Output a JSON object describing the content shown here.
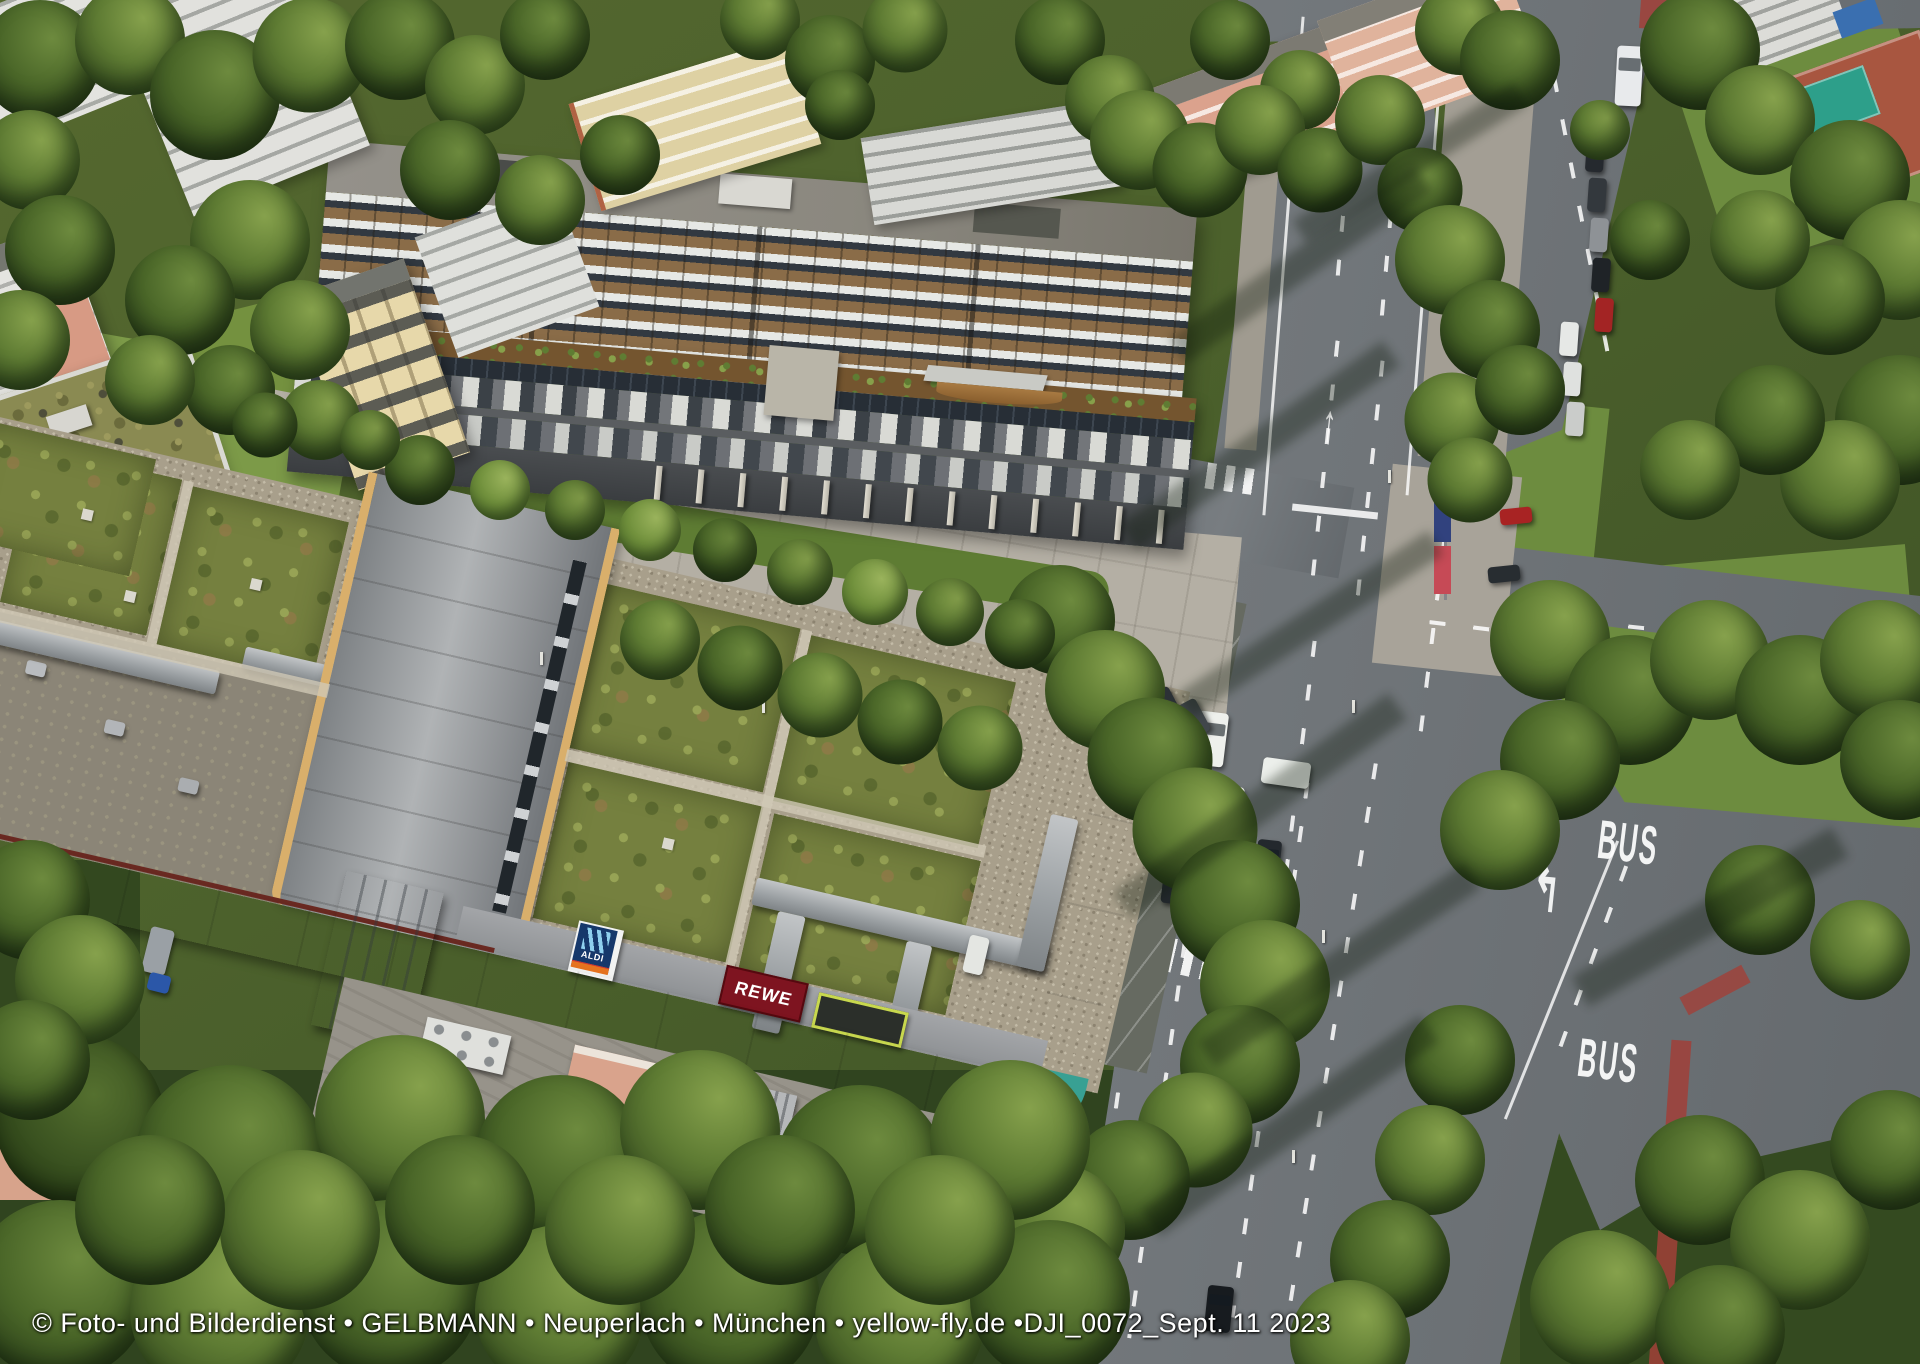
{
  "watermark": {
    "text": "© Foto- und Bilderdienst • GELBMANN • Neuperlach • München • yellow-fly.de •DJI_0072_Sept. 11 2023"
  },
  "signs": {
    "aldi": {
      "label": "ALDI"
    },
    "rewe": {
      "label": "REWE"
    }
  },
  "road_markings": {
    "bus_lane_labels": [
      "BUS",
      "BUS"
    ]
  },
  "colors": {
    "fascia_teal": "#3fa596",
    "aldi_navy": "#16386b",
    "aldi_orange": "#e5731f",
    "rewe_red": "#7e1420",
    "bike_lane_red": "#a14038",
    "court_red": "#a85640",
    "court_green": "#2d9f8a"
  }
}
